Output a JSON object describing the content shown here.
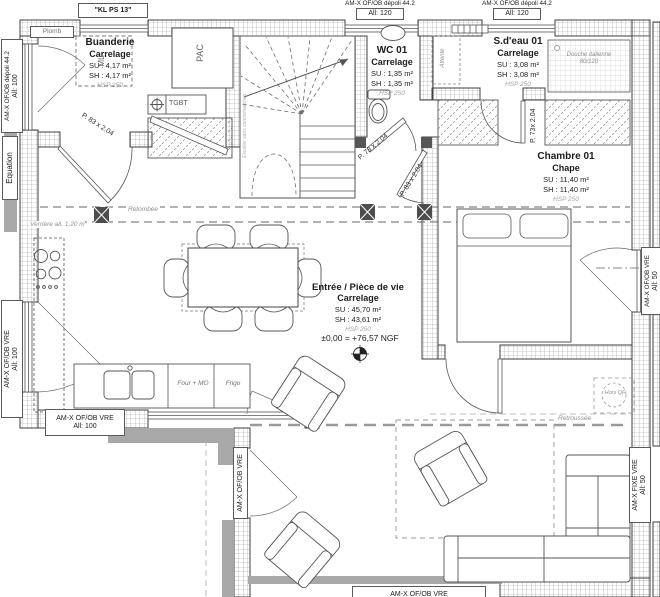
{
  "labels": {
    "kl": "\"KL PS 13\"",
    "plomb": "Plomb",
    "top_win1": {
      "l1": "AM-X OF/OB dépoli 44.2",
      "l2": "All: 120"
    },
    "top_win2": {
      "l1": "AM-X OF/OB dépoli 44.2",
      "l2": "All: 120"
    },
    "left_top": {
      "l1": "AM-X OF/OB dépoli 44.2",
      "l2": "All: 100"
    },
    "equation": "Equation",
    "left_bottom": {
      "l1": "AM-X OF/OB VRE",
      "l2": "All: 100"
    },
    "bottom_left": {
      "l1": "AM-X OF/OB VRE",
      "l2": "All: 100"
    },
    "right_mid": {
      "l1": "AM-X OF/OB VRE",
      "l2": "All: 50"
    },
    "ext_left": "AM-X OF/OB VRE",
    "right_bottom": {
      "l1": "AM-X FIXE VRE",
      "l2": "All: 50"
    },
    "bottom_center": "AM-X OF/OB VRE"
  },
  "rooms": {
    "buanderie": {
      "name": "Buanderie",
      "finish": "Carrelage",
      "su": "SU : 4,17 m²",
      "sh": "SH : 4,17 m²",
      "hsp": "HSP 250"
    },
    "wc": {
      "name": "WC 01",
      "finish": "Carrelage",
      "su": "SU : 1,35 m²",
      "sh": "SH : 1,35 m²",
      "hsp": "HSP 250"
    },
    "sdeau": {
      "name": "S.d'eau 01",
      "finish": "Carrelage",
      "su": "SU : 3,08 m²",
      "sh": "SH : 3,08 m²",
      "hsp": "HSP 250"
    },
    "chambre": {
      "name": "Chambre 01",
      "finish": "Chape",
      "su": "SU : 11,40 m²",
      "sh": "SH : 11,40 m²",
      "hsp": "HSP 250"
    },
    "sejour": {
      "name": "Entrée / Pièce de vie",
      "finish": "Carrelage",
      "su": "SU : 45,70 m²",
      "sh": "SH : 43,61 m²",
      "hsp": "HSP 250",
      "level": "±0,00 = +76,57 NGF"
    }
  },
  "doors": {
    "buanderie": "P. 83 x 2.04",
    "wc": "P. 73 x 2.04",
    "hall": "P. 83 x 2.04",
    "chambre": "P. 73x 2.04"
  },
  "annotations": {
    "retombee": "Retombée",
    "verriere": "Verrière all. 1,20 m",
    "four_mo": "Four + MO",
    "frigo": "Frigo",
    "ml": "ML",
    "pac": "PAC",
    "tgbt": "TGBT",
    "attente": "Attente",
    "douche_l1": "Douche italienne",
    "douche_l2": "80/120",
    "stair_note": "Escalier sans contremarches",
    "hors_qf": "Hors QF",
    "retroussee": "Retroussée"
  }
}
